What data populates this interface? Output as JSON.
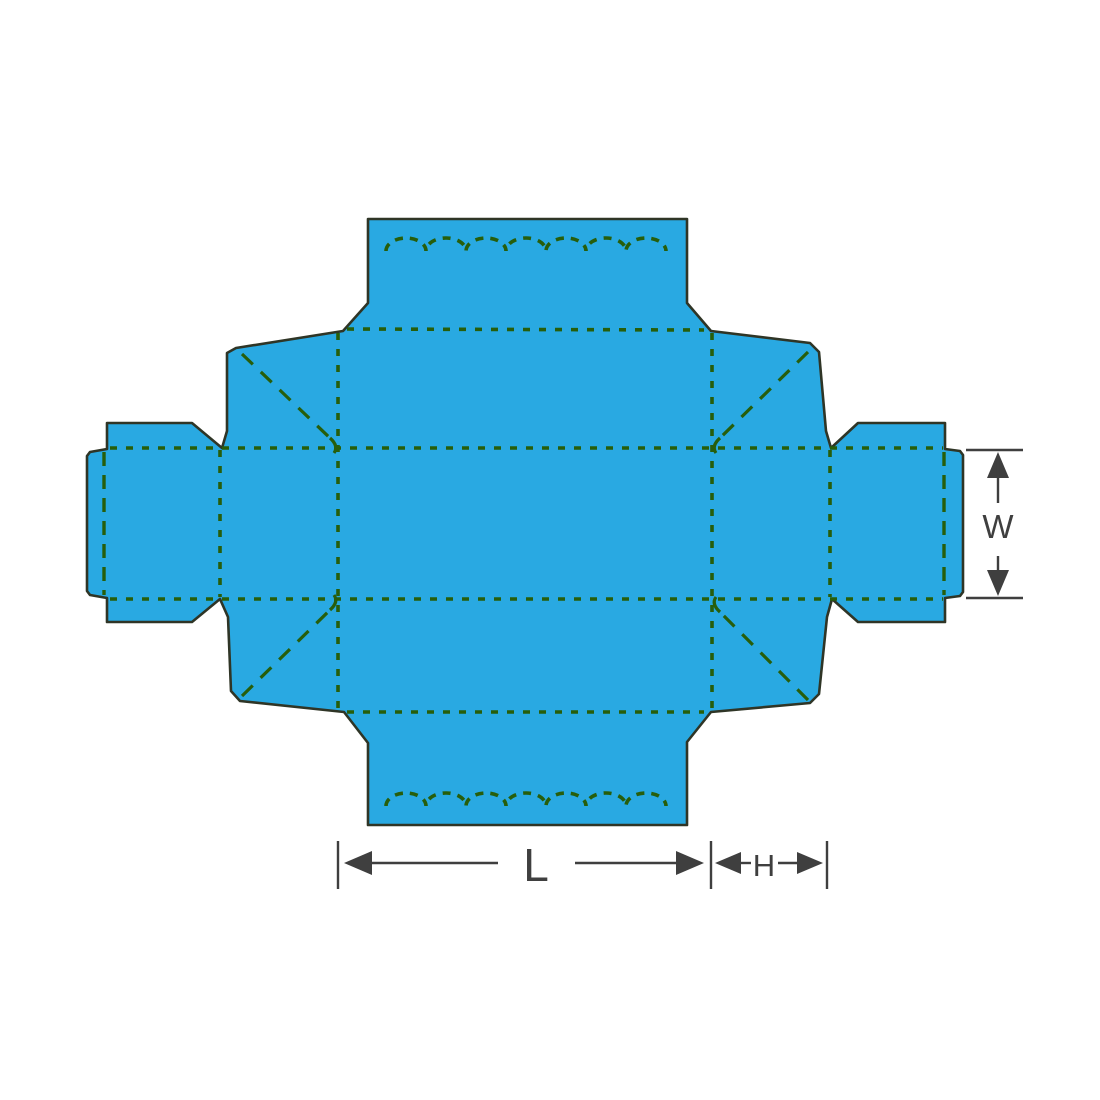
{
  "diagram": {
    "type": "packaging-box-dieline",
    "dimension_labels": {
      "length": "L",
      "height": "H",
      "width": "W"
    },
    "colors": {
      "panel_fill": "#29A9E2",
      "outline": "#2F3526",
      "fold_line": "#275E0B",
      "dimension_line": "#3F3F3F",
      "background": "#FFFFFF"
    }
  }
}
